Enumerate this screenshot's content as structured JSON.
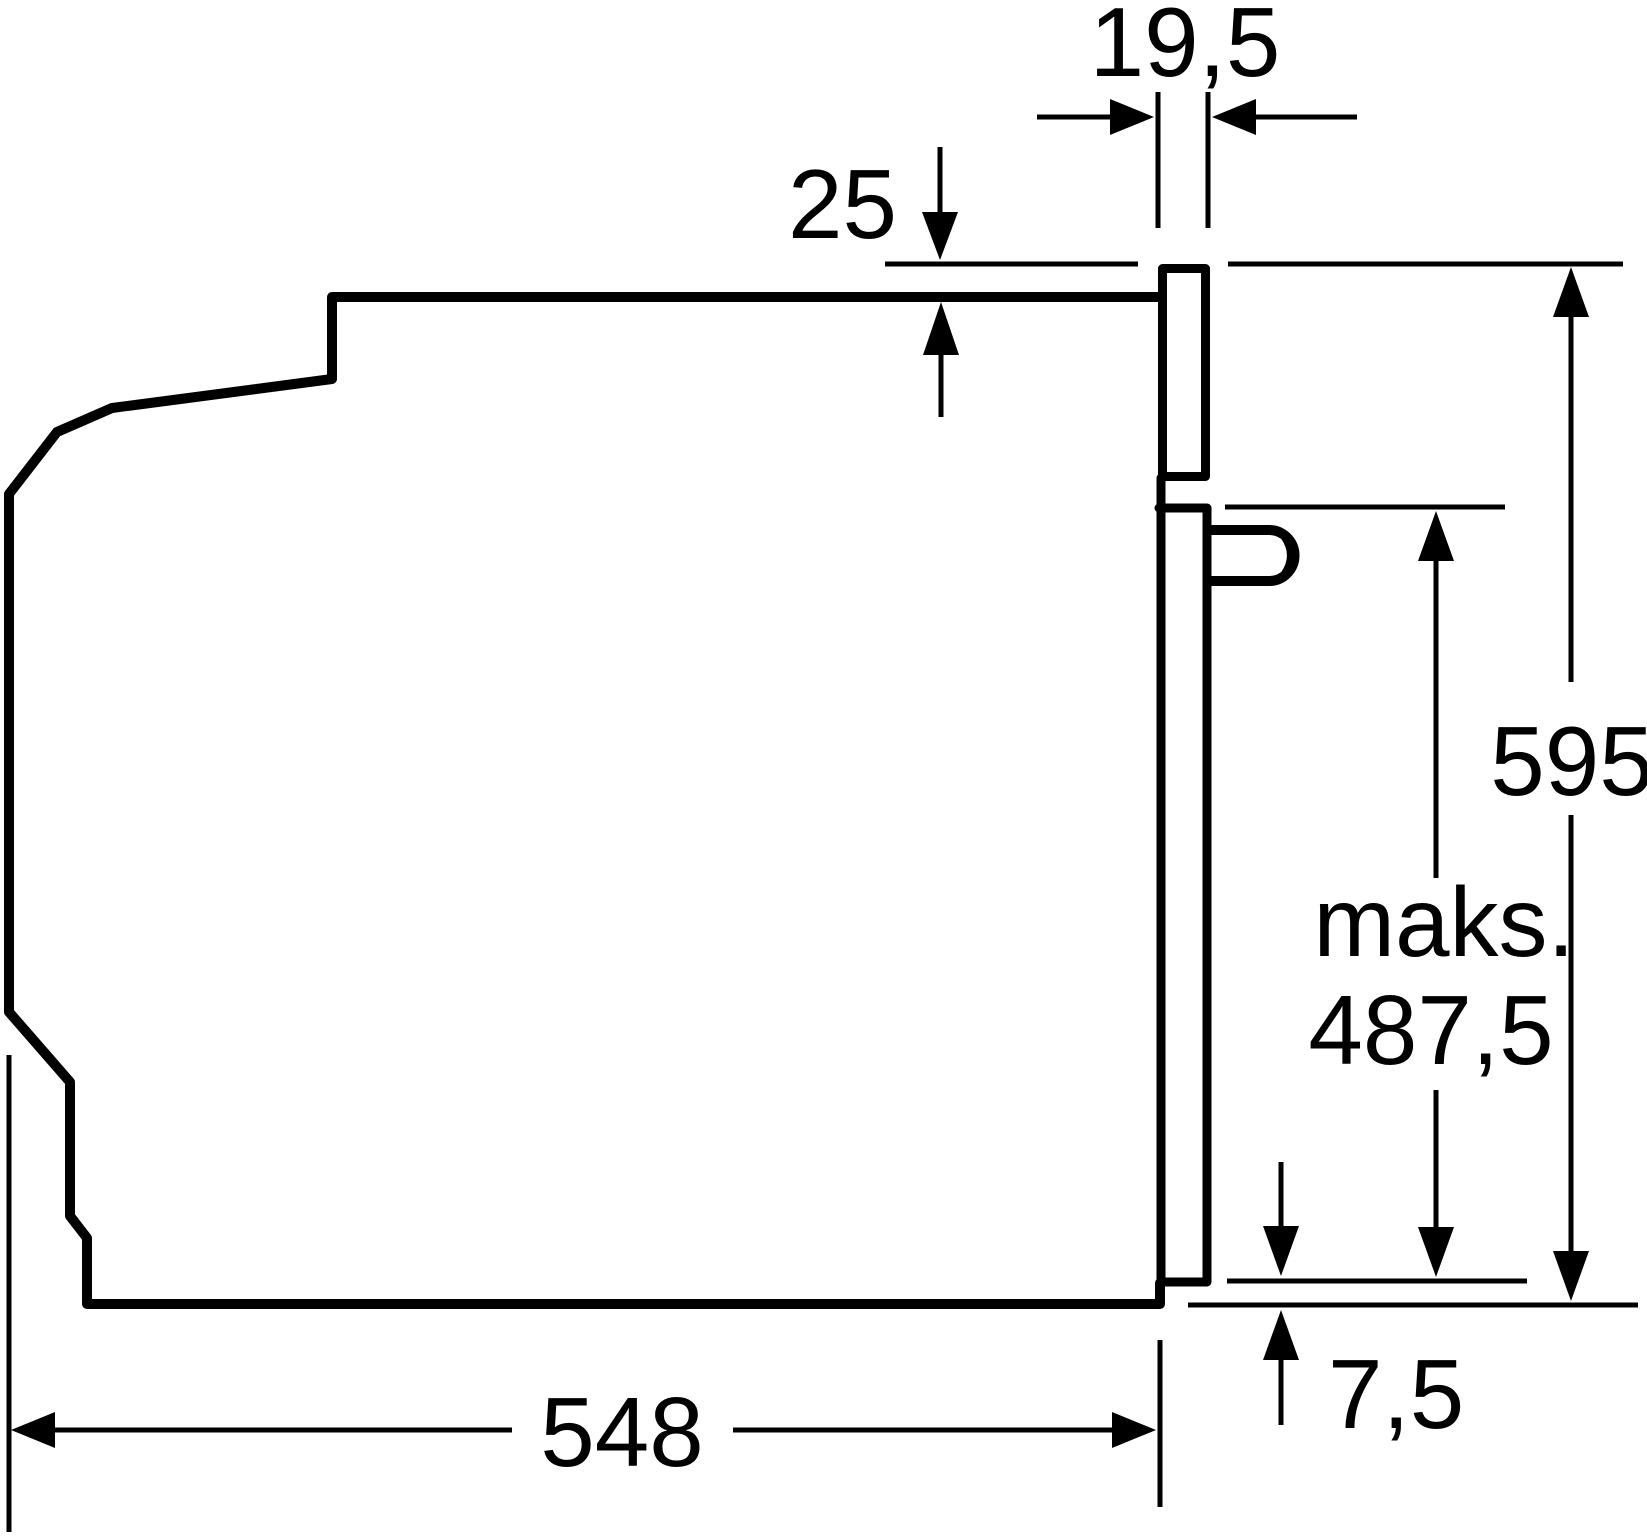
{
  "diagram": {
    "subject": "built-in-oven-side-profile-dimension-drawing",
    "background_color": "#ffffff",
    "line_color": "#000000",
    "labels": {
      "frame_thickness": "19,5",
      "top_overhang": "25",
      "front_height": "595",
      "max_prefix": "maks.",
      "max_handle_height": "487,5",
      "bottom_offset": "7,5",
      "depth": "548"
    }
  }
}
